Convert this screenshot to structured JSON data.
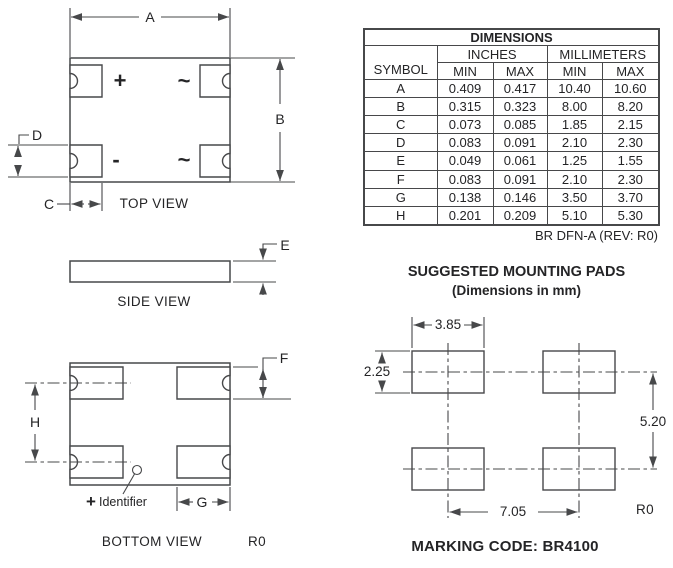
{
  "colors": {
    "line": "#47484a",
    "text": "#242426",
    "background": "#ffffff"
  },
  "top_view": {
    "label": "TOP VIEW",
    "dims": {
      "a": "A",
      "b": "B",
      "c": "C",
      "d": "D"
    },
    "pins": {
      "plus": "+",
      "minus": "-",
      "ac_top": "~",
      "ac_bottom": "~"
    }
  },
  "side_view": {
    "label": "SIDE VIEW",
    "dims": {
      "e": "E"
    }
  },
  "bottom_view": {
    "label": "BOTTOM VIEW",
    "dims": {
      "f": "F",
      "g": "G",
      "h": "H"
    },
    "identifier_plus": "+",
    "identifier_label": "Identifier",
    "rev": "R0"
  },
  "table": {
    "title": "DIMENSIONS",
    "symbol_header": "SYMBOL",
    "inches_header": "INCHES",
    "mm_header": "MILLIMETERS",
    "min_header": "MIN",
    "max_header": "MAX",
    "rows": [
      {
        "symbol": "A",
        "inch_min": "0.409",
        "inch_max": "0.417",
        "mm_min": "10.40",
        "mm_max": "10.60"
      },
      {
        "symbol": "B",
        "inch_min": "0.315",
        "inch_max": "0.323",
        "mm_min": "8.00",
        "mm_max": "8.20"
      },
      {
        "symbol": "C",
        "inch_min": "0.073",
        "inch_max": "0.085",
        "mm_min": "1.85",
        "mm_max": "2.15"
      },
      {
        "symbol": "D",
        "inch_min": "0.083",
        "inch_max": "0.091",
        "mm_min": "2.10",
        "mm_max": "2.30"
      },
      {
        "symbol": "E",
        "inch_min": "0.049",
        "inch_max": "0.061",
        "mm_min": "1.25",
        "mm_max": "1.55"
      },
      {
        "symbol": "F",
        "inch_min": "0.083",
        "inch_max": "0.091",
        "mm_min": "2.10",
        "mm_max": "2.30"
      },
      {
        "symbol": "G",
        "inch_min": "0.138",
        "inch_max": "0.146",
        "mm_min": "3.50",
        "mm_max": "3.70"
      },
      {
        "symbol": "H",
        "inch_min": "0.201",
        "inch_max": "0.209",
        "mm_min": "5.10",
        "mm_max": "5.30"
      }
    ],
    "footnote": "BR DFN-A (REV: R0)"
  },
  "mounting": {
    "title": "SUGGESTED MOUNTING PADS",
    "subtitle": "(Dimensions in mm)",
    "pad_width": "3.85",
    "pad_height": "2.25",
    "row_pitch": "5.20",
    "col_pitch": "7.05",
    "rev": "R0"
  },
  "marking_code": "MARKING CODE: BR4100"
}
